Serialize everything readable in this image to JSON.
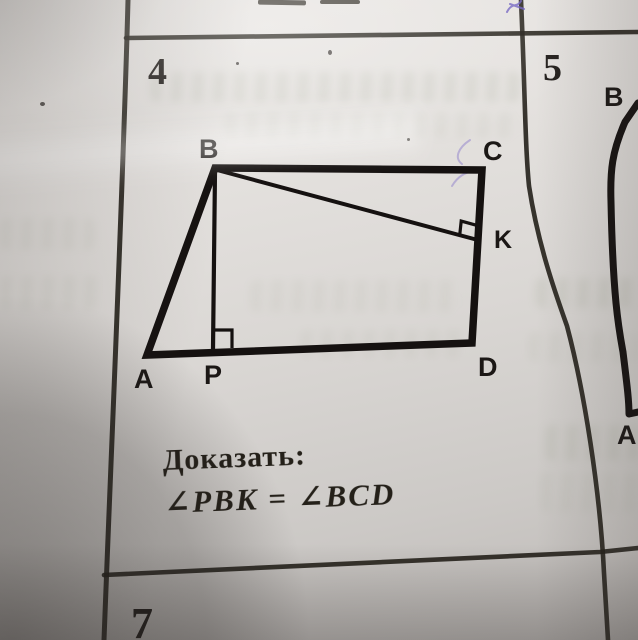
{
  "colors": {
    "ink": "#1c1917",
    "pen_mark": "#6f5fc0"
  },
  "cells": {
    "problem4": {
      "number": "4",
      "labels": {
        "a": "A",
        "b": "B",
        "c": "C",
        "d": "D",
        "p": "P",
        "k": "K"
      },
      "prove_label": "Доказать:",
      "prove_statement": "∠PBK = ∠BCD"
    },
    "problem5": {
      "number": "5",
      "labels": {
        "b": "B",
        "a": "A"
      }
    },
    "problem7": {
      "number": "7"
    }
  }
}
